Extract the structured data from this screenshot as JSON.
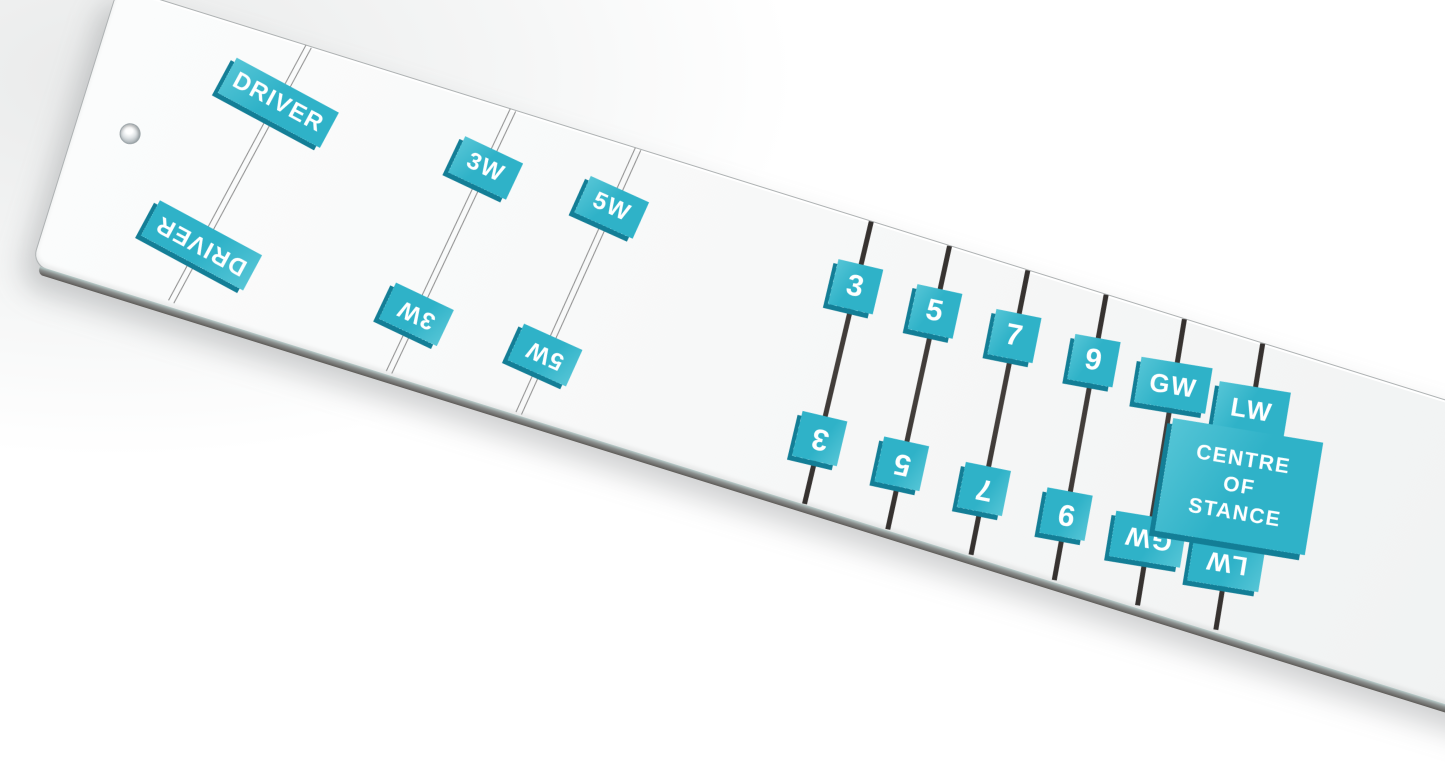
{
  "scene": {
    "background_color": "#f3f4f4",
    "board_color": "#f7f8f8",
    "accent_color": "#2fb2c8",
    "accent_light": "#55c5d6",
    "accent_dark": "#137e96",
    "wood_line_color": "#8d8d8d",
    "iron_line_color": "#3a3634",
    "hole_present": true
  },
  "board": {
    "clubs": [
      {
        "id": "driver",
        "label": "DRIVER",
        "type": "wood",
        "pos": 199,
        "lean": 11,
        "w": 116,
        "h": 40,
        "font": 24
      },
      {
        "id": "3-wood",
        "label": "3W",
        "type": "wood",
        "pos": 413,
        "lean": 8,
        "w": 64,
        "h": 40,
        "font": 24
      },
      {
        "id": "5-wood",
        "label": "5W",
        "type": "wood",
        "pos": 544,
        "lean": 7,
        "w": 64,
        "h": 40,
        "font": 24
      },
      {
        "id": "3-iron",
        "label": "3",
        "type": "iron",
        "pos": 788,
        "lean": -4,
        "w": 46,
        "h": 46,
        "font": 30
      },
      {
        "id": "5-iron",
        "label": "5",
        "type": "iron",
        "pos": 870,
        "lean": -5,
        "w": 46,
        "h": 46,
        "font": 30
      },
      {
        "id": "7-iron",
        "label": "7",
        "type": "iron",
        "pos": 952,
        "lean": -6,
        "w": 46,
        "h": 46,
        "font": 30
      },
      {
        "id": "9-iron",
        "label": "9",
        "type": "iron",
        "pos": 1034,
        "lean": -7,
        "w": 46,
        "h": 46,
        "font": 30
      },
      {
        "id": "gap-wedge",
        "label": "GW",
        "type": "iron",
        "pos": 1116,
        "lean": -8,
        "w": 72,
        "h": 46,
        "font": 26
      },
      {
        "id": "lob-wedge",
        "label": "LW",
        "type": "iron",
        "pos": 1198,
        "lean": -8,
        "w": 72,
        "h": 46,
        "font": 26,
        "has_centre_block": true
      }
    ],
    "centre_block": {
      "lines": [
        "CENTRE",
        "OF",
        "STANCE"
      ]
    }
  }
}
